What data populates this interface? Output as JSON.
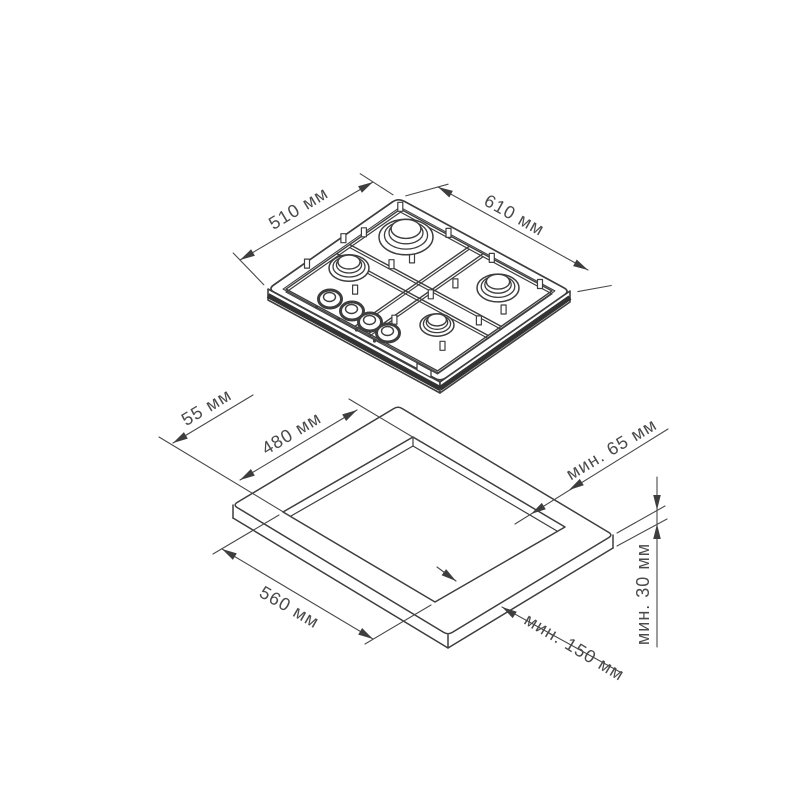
{
  "hob_view": {
    "depth_dimension": "510 мм",
    "width_dimension": "610 мм"
  },
  "cutout_view": {
    "side_offset": "55 мм",
    "cutout_depth": "480 мм",
    "cutout_width": "560 мм",
    "rear_clearance": "мин. 65 мм",
    "front_clearance": "мин. 150 мм",
    "worktop_thickness": "мин. 30 мм"
  },
  "colors": {
    "line": "#3e3e3e",
    "dimension_text": "#4a4a4a",
    "background": "#ffffff"
  }
}
